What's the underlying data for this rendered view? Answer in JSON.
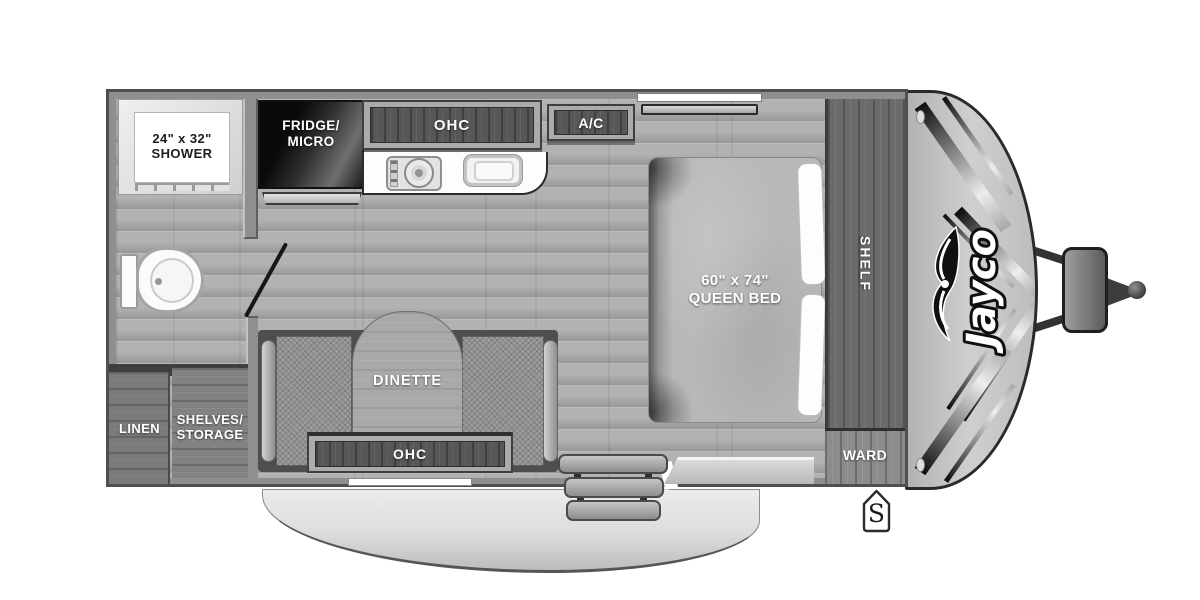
{
  "document": {
    "type": "travel-trailer-floorplan"
  },
  "brand": {
    "logo_text": "Jayco"
  },
  "bathroom": {
    "shower_size": "24\" x 32\"",
    "shower_name": "SHOWER"
  },
  "kitchen": {
    "fridge_line1": "FRIDGE/",
    "fridge_line2": "MICRO",
    "ohc": "OHC",
    "ac": "A/C"
  },
  "bedroom": {
    "bed_size": "60\" x 74\"",
    "bed_name": "QUEEN BED",
    "shelf": "SHELF",
    "ward": "WARD"
  },
  "dinette": {
    "name": "DINETTE",
    "ohc": "OHC"
  },
  "storage": {
    "linen": "LINEN",
    "shelves_line1": "SHELVES/",
    "shelves_line2": "STORAGE"
  },
  "exterior": {
    "awning": "10' AWNING",
    "badge": "S"
  },
  "colors": {
    "wall": "#8f8f8f",
    "floor": "#b2b2b2",
    "cabinet": "#6b6b6b",
    "panel": "#575757",
    "shell": "#4e4e4e",
    "fridge": "#0a0a0a",
    "cap": "#cfcfcf",
    "awning": "#dcdcdc",
    "white": "#ffffff",
    "outline": "#4f4f4f",
    "text_light": "#ffffff",
    "text_dark": "#1e1e1e"
  }
}
